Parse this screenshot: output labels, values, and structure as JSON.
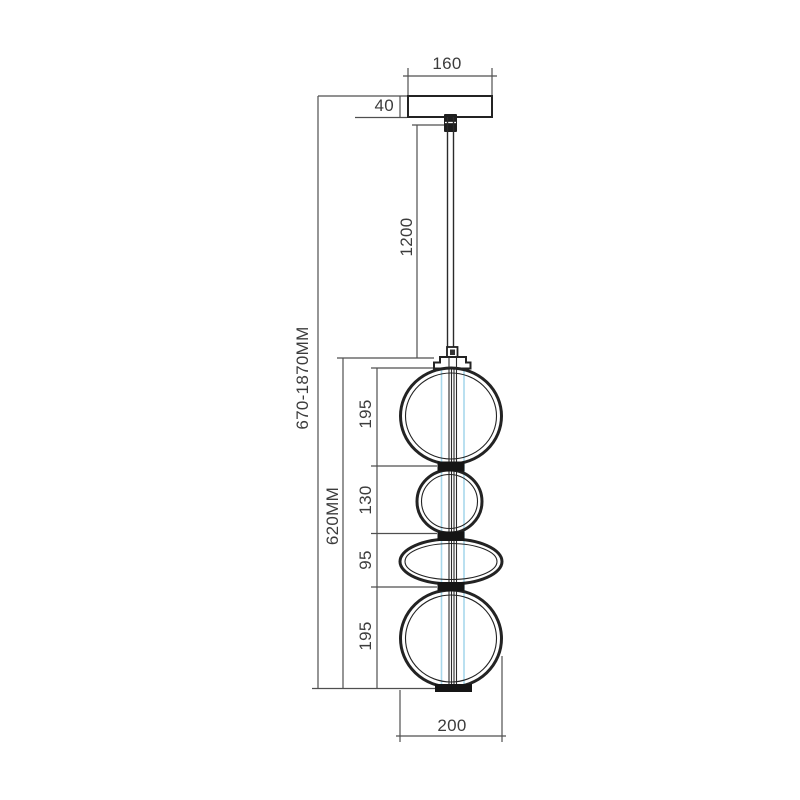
{
  "drawing": {
    "labels": {
      "canopy_width": "160",
      "canopy_height": "40",
      "cord_length": "1200",
      "overall_height": "670-1870MM",
      "fixture_height": "620MM",
      "segment_top": "195",
      "segment_upper_mid": "130",
      "segment_lower_mid": "95",
      "segment_bottom": "195",
      "bottom_width": "200"
    },
    "colors": {
      "outline": "#232323",
      "dimension_line": "#4f4f4f",
      "label_text": "#3c3c3c",
      "tube_accent": "#a9d9ec",
      "background": "#ffffff"
    }
  }
}
